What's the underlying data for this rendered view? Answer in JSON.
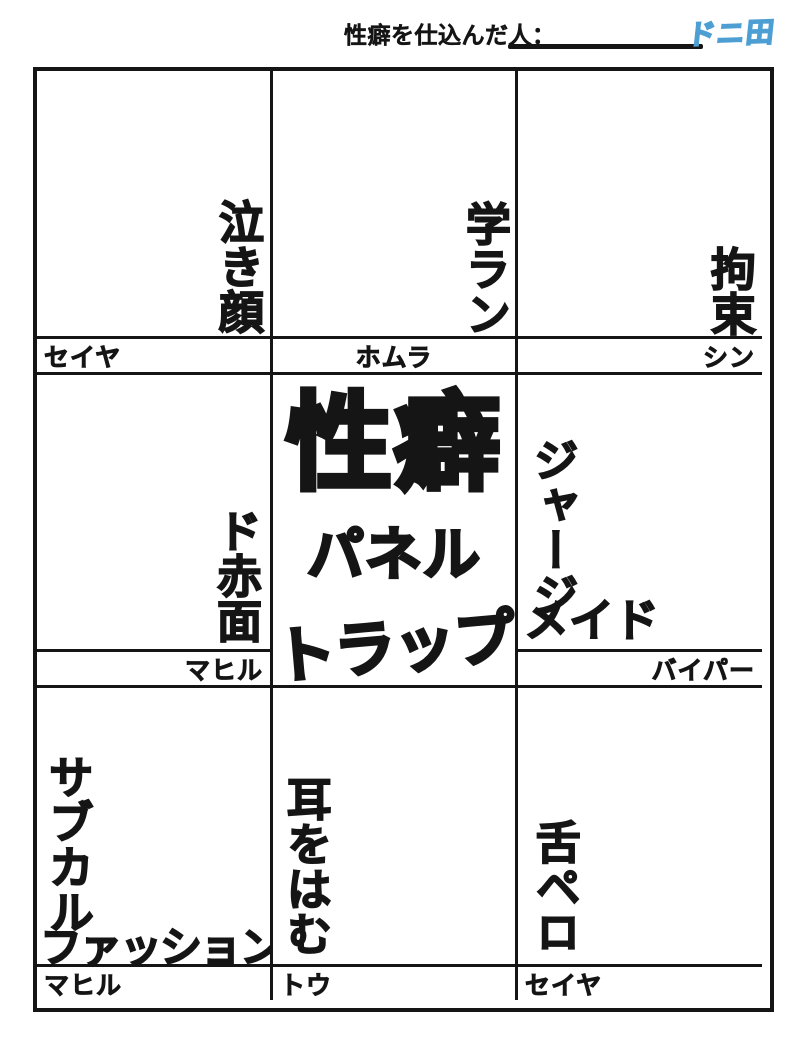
{
  "header": {
    "label": "性癖を仕込んだ人：",
    "logo_text": "ドニ田",
    "logo_color": "#4d9fd3"
  },
  "center_title": {
    "line1": "性癖",
    "line2": "パネル",
    "line3": "トラップ"
  },
  "panels": [
    {
      "position": "top-left",
      "label": "泣き顔",
      "player": "セイヤ"
    },
    {
      "position": "top-center",
      "label": "学ラン",
      "player": "ホムラ"
    },
    {
      "position": "top-right",
      "label": "拘束",
      "player": "シン"
    },
    {
      "position": "middle-left",
      "label": "ド赤面",
      "player": "マヒル"
    },
    {
      "position": "middle-right",
      "label_vertical": "ジャージ",
      "label_horizontal": "メイド",
      "player": "バイパー"
    },
    {
      "position": "bottom-left",
      "label_vertical": "サブカル",
      "label_horizontal": "ファッション",
      "player": "マヒル"
    },
    {
      "position": "bottom-center",
      "label": "耳をはむ",
      "player": "トウ"
    },
    {
      "position": "bottom-right",
      "label": "舌ペロ",
      "player": "セイヤ"
    }
  ],
  "colors": {
    "line": "#151515",
    "background": "#ffffff",
    "logo_blue": "#4d9fd3"
  }
}
